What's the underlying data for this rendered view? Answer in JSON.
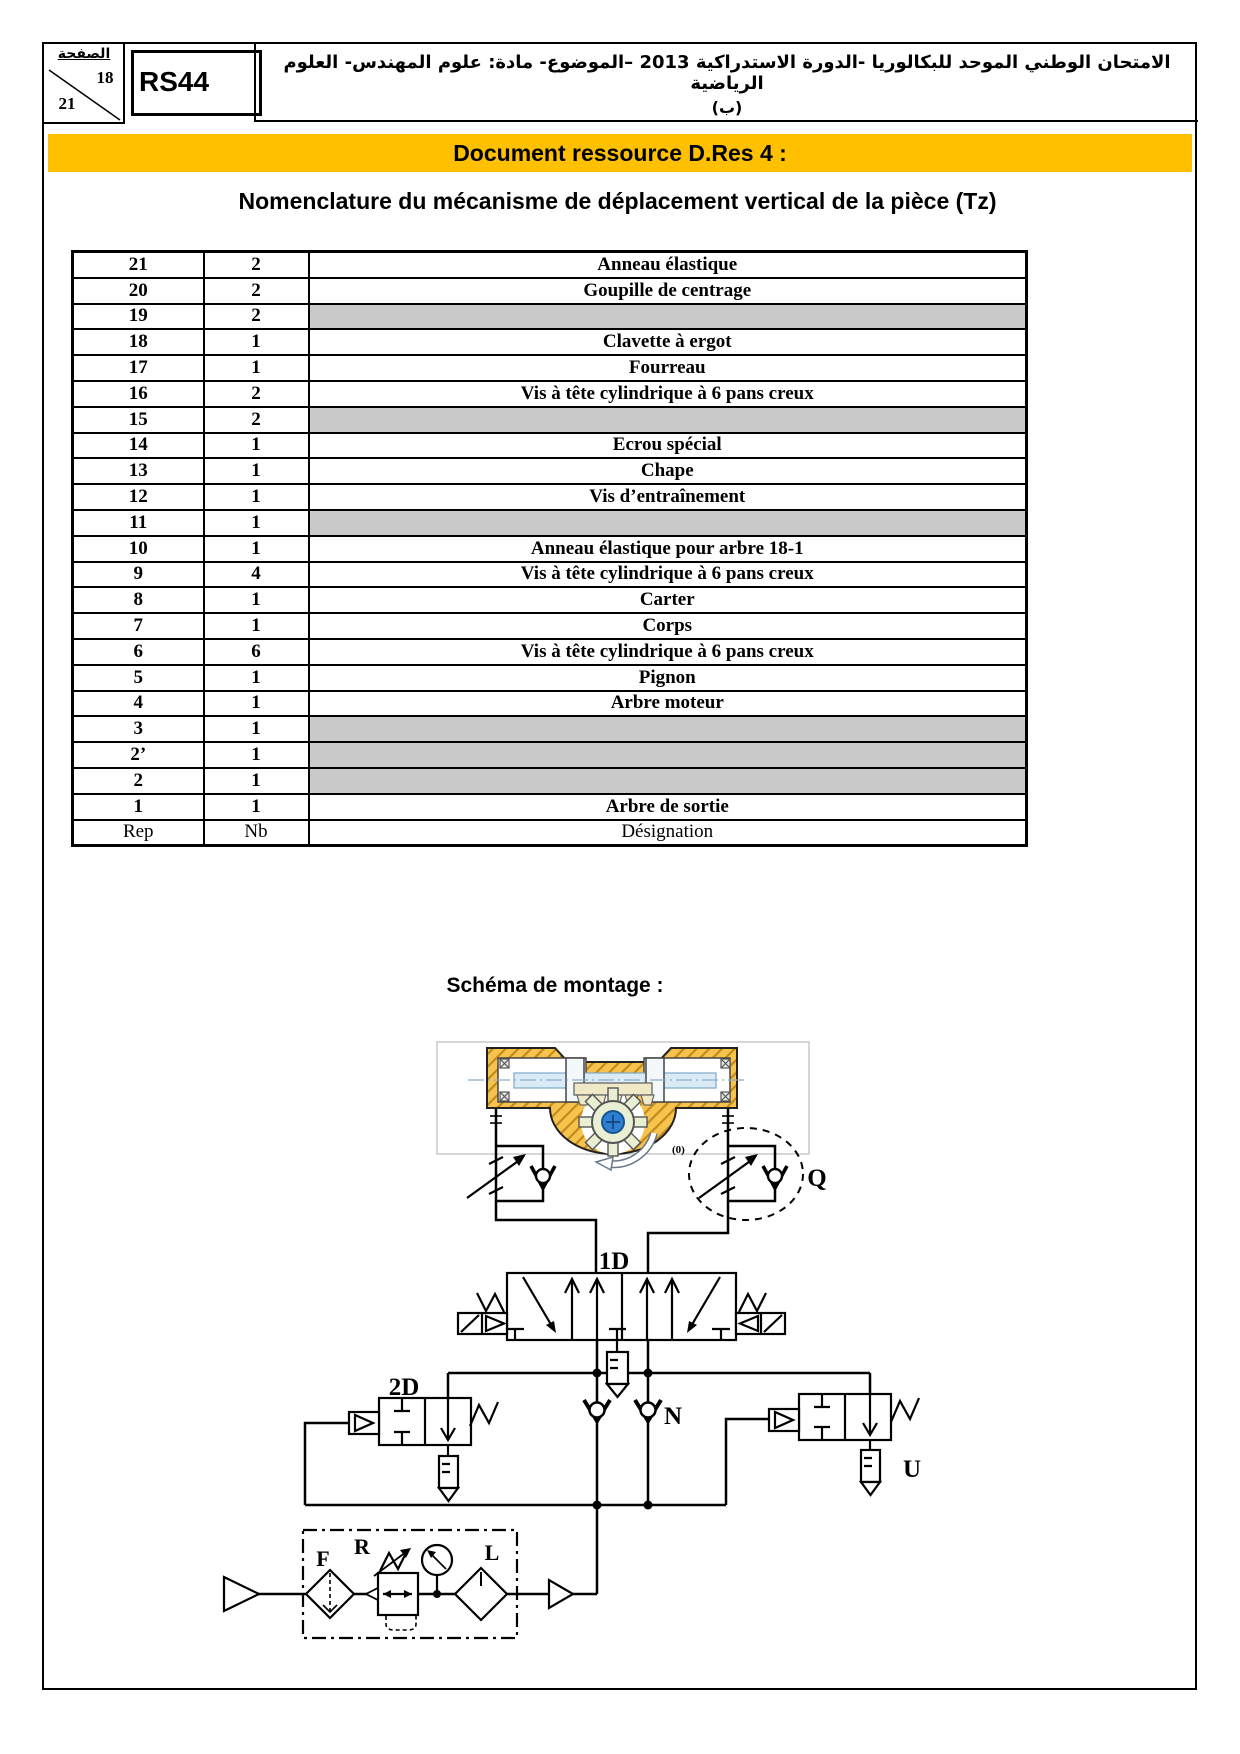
{
  "header": {
    "page_box": {
      "label": "الصفحة",
      "page_num": "18",
      "page_total": "21"
    },
    "code": "RS44",
    "exam_line1": "الامتحان الوطني الموحد للبكالوريا -الدورة الاستدراكية 2013 –الموضوع- مادة: علوم المهندس- العلوم الرياضية",
    "exam_line2": "(ب)"
  },
  "banner": {
    "text": "Document ressource D.Res 4 :",
    "bg": "#FFC000"
  },
  "title": "Nomenclature du mécanisme de déplacement vertical de la pièce (Tz)",
  "table": {
    "footer": {
      "rep": "Rep",
      "nb": "Nb",
      "designation": "Désignation"
    },
    "shaded_color": "#C9C9C9",
    "rows": [
      {
        "rep": "21",
        "nb": "2",
        "designation": "Anneau élastique",
        "shaded": false
      },
      {
        "rep": "20",
        "nb": "2",
        "designation": "Goupille de centrage",
        "shaded": false
      },
      {
        "rep": "19",
        "nb": "2",
        "designation": "",
        "shaded": true
      },
      {
        "rep": "18",
        "nb": "1",
        "designation": "Clavette à ergot",
        "shaded": false
      },
      {
        "rep": "17",
        "nb": "1",
        "designation": "Fourreau",
        "shaded": false
      },
      {
        "rep": "16",
        "nb": "2",
        "designation": "Vis à tête cylindrique à 6 pans creux",
        "shaded": false
      },
      {
        "rep": "15",
        "nb": "2",
        "designation": "",
        "shaded": true
      },
      {
        "rep": "14",
        "nb": "1",
        "designation": "Ecrou spécial",
        "shaded": false
      },
      {
        "rep": "13",
        "nb": "1",
        "designation": "Chape",
        "shaded": false
      },
      {
        "rep": "12",
        "nb": "1",
        "designation": "Vis d’entraînement",
        "shaded": false
      },
      {
        "rep": "11",
        "nb": "1",
        "designation": "",
        "shaded": true
      },
      {
        "rep": "10",
        "nb": "1",
        "designation": "Anneau élastique pour arbre 18-1",
        "shaded": false
      },
      {
        "rep": "9",
        "nb": "4",
        "designation": "Vis à tête cylindrique à 6 pans creux",
        "shaded": false
      },
      {
        "rep": "8",
        "nb": "1",
        "designation": "Carter",
        "shaded": false
      },
      {
        "rep": "7",
        "nb": "1",
        "designation": "Corps",
        "shaded": false
      },
      {
        "rep": "6",
        "nb": "6",
        "designation": "Vis à tête cylindrique à 6 pans creux",
        "shaded": false
      },
      {
        "rep": "5",
        "nb": "1",
        "designation": "Pignon",
        "shaded": false
      },
      {
        "rep": "4",
        "nb": "1",
        "designation": "Arbre moteur",
        "shaded": false
      },
      {
        "rep": "3",
        "nb": "1",
        "designation": "",
        "shaded": true
      },
      {
        "rep": "2’",
        "nb": "1",
        "designation": "",
        "shaded": true
      },
      {
        "rep": "2",
        "nb": "1",
        "designation": "",
        "shaded": true
      },
      {
        "rep": "1",
        "nb": "1",
        "designation": "Arbre de sortie",
        "shaded": false
      }
    ]
  },
  "schema": {
    "heading": "Schéma de montage :",
    "labels": {
      "valve_1d": "1D",
      "valve_2d": "2D",
      "check_n": "N",
      "silencer_u": "U",
      "fcv_q": "Q",
      "filter_f": "F",
      "regulator_r": "R",
      "lubricator_l": "L",
      "rotation_mark": "(0)"
    }
  },
  "colors": {
    "banner_yellow": "#FFC000",
    "shaded_gray": "#C9C9C9",
    "actuator_yellow": "#F6C44D",
    "hatch_orange": "#C28A1E",
    "gear_green": "#E9EFD2",
    "hub_blue": "#2E7FD2",
    "rod_blue": "#D9EBF7",
    "rotation_red": "#CC3333"
  }
}
